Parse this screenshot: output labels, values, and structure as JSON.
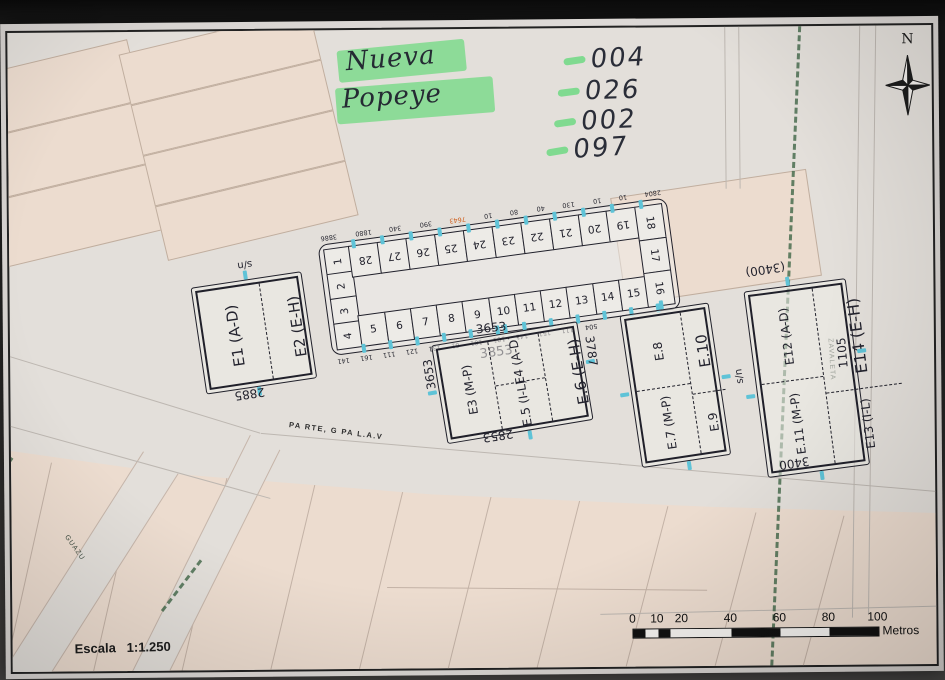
{
  "map": {
    "compass": {
      "label": "N"
    },
    "scale": {
      "label": "Escala",
      "ratio": "1:1.250"
    },
    "scale_bar": {
      "ticks": [
        0,
        10,
        20,
        40,
        60,
        80,
        100
      ],
      "unit": "Metros"
    },
    "street_label": "PA RTE, G PA L.A.V",
    "boundaries": {
      "right": "ZAVALETA",
      "bottom_left": "GUAZU"
    },
    "handwriting": {
      "title_line1": "Nueva",
      "title_line2": "Popeye",
      "codes": [
        "004",
        "026",
        "002",
        "097"
      ],
      "highlight_color": "#6fd982",
      "ink_color": "#23232e",
      "orange_color": "#cf5f1d"
    },
    "blocks": {
      "e1e2": {
        "cell_left": "E1 (A-D)",
        "cell_right": "E2 (E-H)",
        "top_note": "s/n",
        "bottom_note": "2885"
      },
      "central": {
        "left_col": [
          "1",
          "2",
          "3",
          "4"
        ],
        "top_row": [
          "28",
          "27",
          "26",
          "25",
          "24",
          "23",
          "22",
          "21",
          "20",
          "19"
        ],
        "bottom_row": [
          "5",
          "6",
          "7",
          "8",
          "9",
          "10",
          "11",
          "12",
          "13",
          "14",
          "15"
        ],
        "right_col": [
          "18",
          "17",
          "16"
        ],
        "top_marks": [
          "3886",
          "1880",
          "340",
          "390",
          "7643",
          "10",
          "80",
          "40",
          "130",
          "10",
          "10",
          "2804"
        ],
        "orange_mark_index": 4,
        "bottom_marks": [
          "141",
          "161",
          "111",
          "121",
          "131",
          "61",
          "101",
          "101",
          "141",
          "151",
          "111",
          "504"
        ],
        "bottom_note": "3853"
      },
      "e3e6": {
        "col_left": "E3 (M-P)",
        "col_mid_top": "E4 (A-D)",
        "col_mid_bottom": "E.5 (I-L)",
        "col_right": "E.6 (E-H)",
        "top_note": "3653",
        "left_note": "3653",
        "right_note": "3787",
        "bottom_note": "2853"
      },
      "e7e10": {
        "col_left_top": "E.8",
        "col_left_bottom": "E.7 (M-P)",
        "col_right_top": "E.10",
        "col_right_bottom": "E.9",
        "side_note": "s/n"
      },
      "e11e14": {
        "col_left_top": "E12 (A-D)",
        "col_left_bottom": "E.11 (M-P)",
        "col_right_top": "E14 (E-H)",
        "col_right_bottom": "E13 (I-L)",
        "top_note": "(3400)",
        "bottom_note": "3400",
        "right_note": "1105"
      }
    },
    "colors": {
      "parcel": "#ecdccf",
      "parcel_line": "#c0ae9f",
      "street": "#e3dfda",
      "tick": "#5fc3d7",
      "dash_green": "#4a6e50"
    }
  }
}
